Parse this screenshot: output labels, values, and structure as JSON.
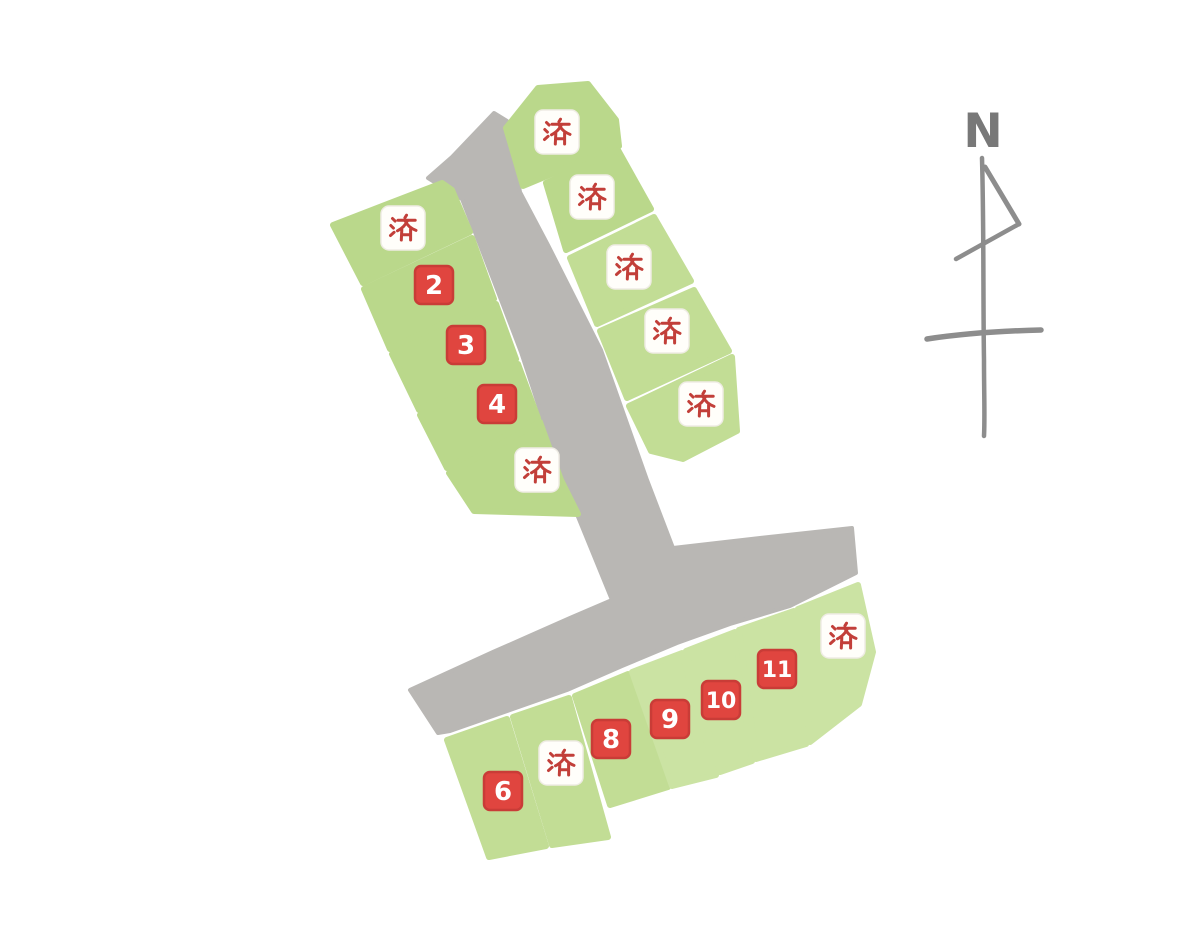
{
  "theme": {
    "bg": "#ffffff",
    "road": "#b9b7b4",
    "green-a": "#bad88b",
    "green-b": "#c2dd95",
    "green-c": "#cbe3a3",
    "badge-red": "#e0453f",
    "badge-red-edge": "#c93c37",
    "badge-white": "#fffefa",
    "sold-red": "#c23f39",
    "compass": "#8d8d8d",
    "compass-letter": "#787878"
  },
  "map": {
    "compass": {
      "label": "N"
    },
    "sold_mark": "済",
    "clusters": [
      {
        "name": "northwest",
        "parcels": [
          {
            "label": "済",
            "status": "sold"
          },
          {
            "label": "2",
            "status": "available"
          },
          {
            "label": "3",
            "status": "available"
          },
          {
            "label": "4",
            "status": "available"
          },
          {
            "label": "済",
            "status": "sold"
          }
        ]
      },
      {
        "name": "northeast",
        "parcels": [
          {
            "label": "済",
            "status": "sold"
          },
          {
            "label": "済",
            "status": "sold"
          },
          {
            "label": "済",
            "status": "sold"
          },
          {
            "label": "済",
            "status": "sold"
          },
          {
            "label": "済",
            "status": "sold"
          }
        ]
      },
      {
        "name": "south",
        "parcels": [
          {
            "label": "6",
            "status": "available"
          },
          {
            "label": "済",
            "status": "sold"
          },
          {
            "label": "8",
            "status": "available"
          },
          {
            "label": "9",
            "status": "available"
          },
          {
            "label": "10",
            "status": "available"
          },
          {
            "label": "11",
            "status": "available"
          },
          {
            "label": "済",
            "status": "sold"
          }
        ]
      }
    ]
  }
}
